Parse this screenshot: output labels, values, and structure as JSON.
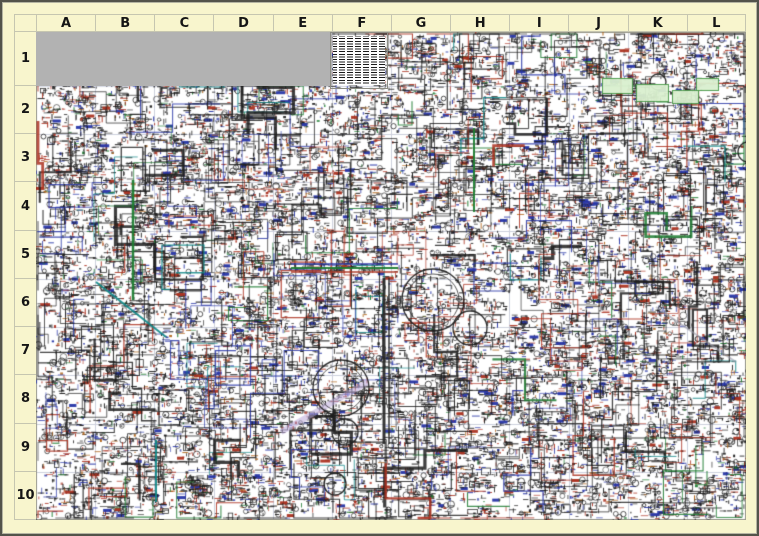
{
  "poster": {
    "kind": "biochemical-pathways-wall-chart",
    "frame_color": "#f8f5cd",
    "border_color": "#53534a",
    "label_color": "#151515",
    "gridline_color": "#c6c6b0"
  },
  "grid": {
    "columns": [
      "A",
      "B",
      "C",
      "D",
      "E",
      "F",
      "G",
      "H",
      "I",
      "J",
      "K",
      "L"
    ],
    "rows": [
      "1",
      "2",
      "3",
      "4",
      "5",
      "6",
      "7",
      "8",
      "9",
      "10"
    ]
  },
  "map": {
    "background": "#ffffff",
    "cell_line_color": "#cdd0dd",
    "outer_line_color": "#9a9a8c",
    "placeholder_box_color": "#b2b2b2",
    "ink_color": "#1f1f1f",
    "label_red": "#ab3120",
    "label_blue": "#2735a6",
    "accent_green": "#1e7d32",
    "accent_teal": "#0d8686",
    "accent_orange": "#b06418",
    "accent_olive": "#8a7a20",
    "accent_lavender": "#b9a8d8"
  },
  "texture": {
    "seed": 1337,
    "clusters": 6500,
    "connectors": 470,
    "color_weights": {
      "ink": 0.62,
      "red": 0.18,
      "blue": 0.13,
      "orange": 0.04,
      "green": 0.03
    }
  },
  "features": {
    "circles": [
      {
        "x": 397,
        "y": 268,
        "r": 31
      },
      {
        "x": 305,
        "y": 356,
        "r": 28
      },
      {
        "x": 309,
        "y": 400,
        "r": 13
      },
      {
        "x": 434,
        "y": 296,
        "r": 17
      },
      {
        "x": 299,
        "y": 452,
        "r": 11
      },
      {
        "x": 712,
        "y": 120,
        "r": 10
      },
      {
        "x": 622,
        "y": 50,
        "r": 8
      }
    ],
    "highways": [
      {
        "pts": [
          [
            255,
            232
          ],
          [
            362,
            232
          ]
        ],
        "color": "#2735a6",
        "w": 1.5,
        "a": 0.95
      },
      {
        "pts": [
          [
            255,
            236
          ],
          [
            362,
            236
          ]
        ],
        "color": "#1e7d32",
        "w": 2,
        "a": 0.95
      },
      {
        "pts": [
          [
            255,
            240
          ],
          [
            362,
            240
          ]
        ],
        "color": "#ab3120",
        "w": 1.5,
        "a": 0.95
      },
      {
        "pts": [
          [
            97,
            148
          ],
          [
            97,
            268
          ]
        ],
        "color": "#1e7d32",
        "w": 2.5,
        "a": 0.95
      },
      {
        "pts": [
          [
            348,
            246
          ],
          [
            348,
            412
          ]
        ],
        "color": "#2a2a2a",
        "w": 3,
        "a": 0.95
      },
      {
        "pts": [
          [
            353,
            246
          ],
          [
            353,
            412
          ]
        ],
        "color": "#2a2a2a",
        "w": 1.5,
        "a": 0.95
      },
      {
        "pts": [
          [
            438,
            96
          ],
          [
            438,
            180
          ]
        ],
        "color": "#1e7d32",
        "w": 2,
        "a": 0.95
      },
      {
        "pts": [
          [
            60,
            250
          ],
          [
            130,
            305
          ]
        ],
        "color": "#0d8686",
        "w": 2,
        "a": 0.9
      },
      {
        "pts": [
          [
            120,
            408
          ],
          [
            120,
            470
          ]
        ],
        "color": "#0d8686",
        "w": 2,
        "a": 0.9
      },
      {
        "pts": [
          [
            245,
            400
          ],
          [
            332,
            350
          ]
        ],
        "color": "#b9a8d8",
        "w": 6,
        "a": 0.55
      },
      {
        "pts": [
          [
            620,
            275
          ],
          [
            700,
            330
          ]
        ],
        "color": "#9a9aa8",
        "w": 2,
        "a": 0.6
      },
      {
        "pts": [
          [
            215,
            512
          ],
          [
            370,
            512
          ]
        ],
        "color": "#8a7a20",
        "w": 2,
        "a": 0.9
      }
    ],
    "green_boxes": [
      {
        "x": 566,
        "y": 46,
        "w": 30,
        "h": 15
      },
      {
        "x": 600,
        "y": 52,
        "w": 32,
        "h": 17
      },
      {
        "x": 636,
        "y": 58,
        "w": 26,
        "h": 13
      },
      {
        "x": 660,
        "y": 46,
        "w": 22,
        "h": 12
      }
    ]
  }
}
